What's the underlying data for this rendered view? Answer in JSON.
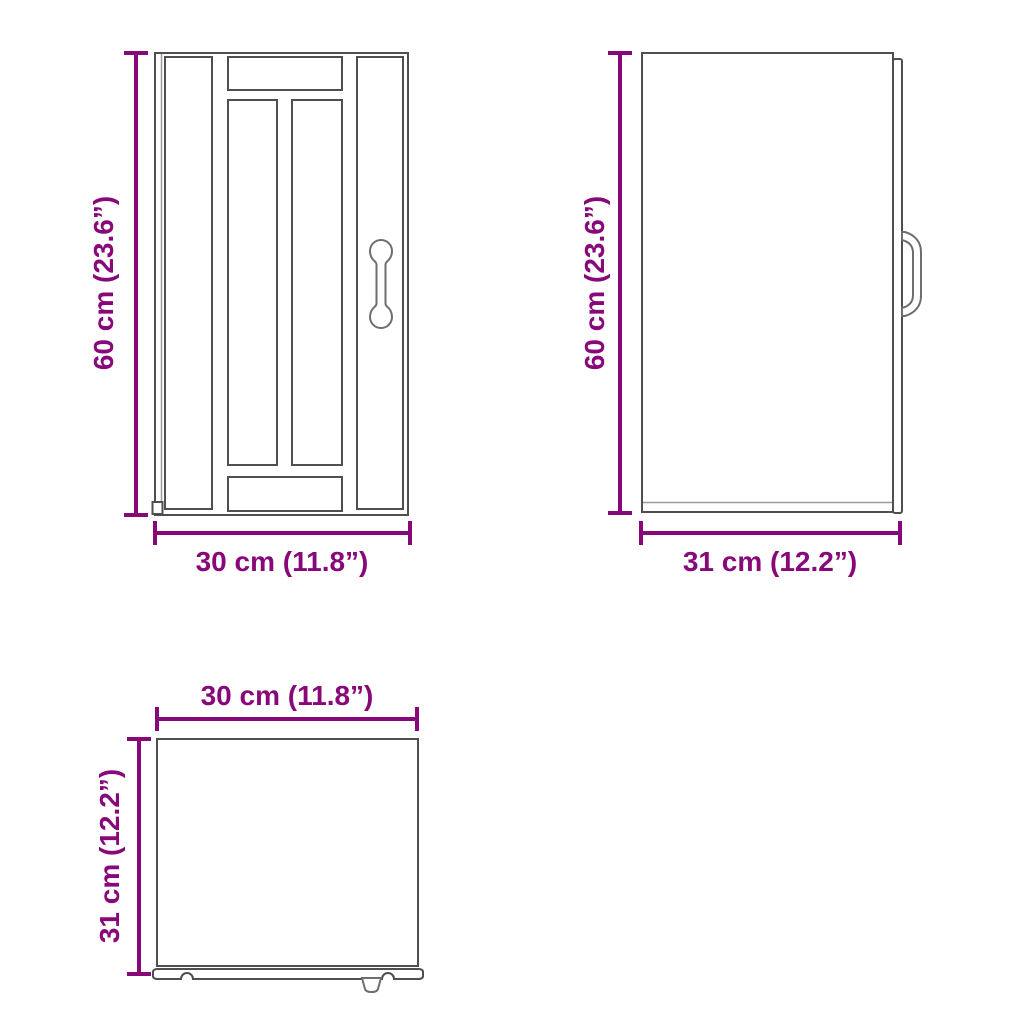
{
  "product": {
    "type": "kitchen wall cabinet dimension diagram"
  },
  "colors": {
    "dimension": "#88087A",
    "line_dark": "#4f4f4f",
    "line_light": "#9a9a9a",
    "background": "#ffffff"
  },
  "views": {
    "front": {
      "height_cm": 60,
      "height_in": 23.6,
      "width_cm": 30,
      "width_in": 11.8,
      "height_label": "60 cm (23.6”)",
      "width_label": "30 cm (11.8”)"
    },
    "side": {
      "height_cm": 60,
      "height_in": 23.6,
      "depth_cm": 31,
      "depth_in": 12.2,
      "height_label": "60 cm (23.6”)",
      "depth_label": "31 cm (12.2”)"
    },
    "top": {
      "width_cm": 30,
      "width_in": 11.8,
      "depth_cm": 31,
      "depth_in": 12.2,
      "width_label": "30 cm (11.8”)",
      "depth_label": "31 cm (12.2”)"
    }
  }
}
